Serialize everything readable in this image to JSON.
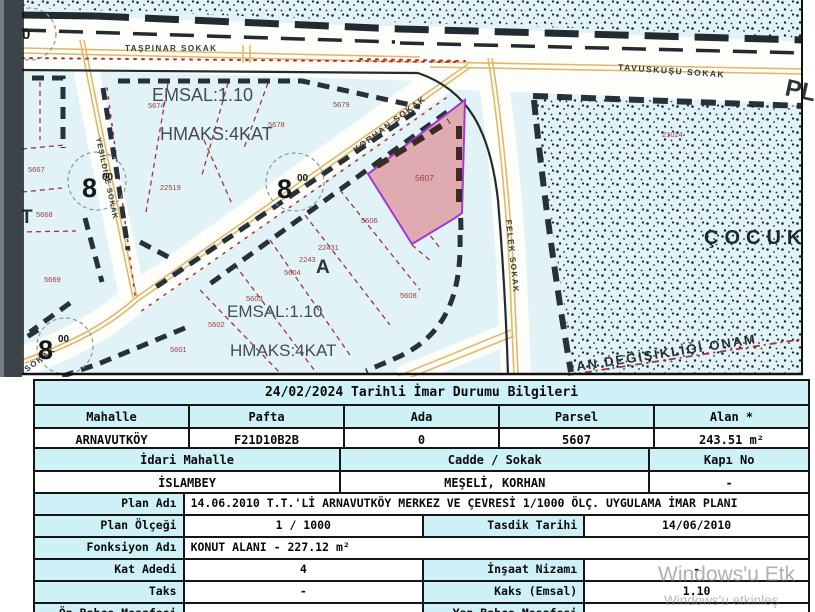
{
  "map": {
    "streets": {
      "taspinar": "TAŞPINAR SOKAK",
      "tavuskusu": "TAVUSKUŞU SOKAK",
      "korhan": "KORHAN SOKAK",
      "yesildide": "YEŞİLDİDE SOKAK",
      "felek": "FELEK SOKAK",
      "sokak_partial": "SOKAK",
      "pl_partial": "PL"
    },
    "zone_labels": {
      "emsal": "EMSAL:1.10",
      "hmaks": "HMAKS:4KAT",
      "cocuk_partial": "ÇOCUK",
      "plan_change_partial": "AN DEĞİŞİKLİĞİ ONAM"
    },
    "road_width": {
      "num": "8",
      "sup": "00",
      "zero_partial": "0"
    },
    "letters": {
      "a": "A",
      "t_partial": "T"
    },
    "highlight_parcel": "5607",
    "parcel_labels": [
      {
        "t": "5607"
      },
      {
        "t": "5606"
      },
      {
        "t": "5608"
      },
      {
        "t": "5601"
      },
      {
        "t": "5602"
      },
      {
        "t": "5603"
      },
      {
        "t": "5604"
      },
      {
        "t": "22431"
      },
      {
        "t": "2243"
      },
      {
        "t": "5667"
      },
      {
        "t": "5668"
      },
      {
        "t": "5669"
      },
      {
        "t": "5674"
      },
      {
        "t": "5678"
      },
      {
        "t": "5679"
      },
      {
        "t": "22519"
      },
      {
        "t": "21024"
      }
    ],
    "colors": {
      "map_bg": "#e2f3f7",
      "road_white": "#fdfdf9",
      "road_yellow": "#dfb869",
      "parcel_fill": "#dfabb0",
      "parcel_border": "#a238d8",
      "parcel_line_red": "#a33636",
      "block_dark": "#26313b",
      "table_header_bg": "#cdf1f6"
    }
  },
  "tables": {
    "parcel_info": {
      "title": "24/02/2024 Tarihli İmar Durumu Bilgileri",
      "headers": [
        "Mahalle",
        "Pafta",
        "Ada",
        "Parsel",
        "Alan *"
      ],
      "values": [
        "ARNAVUTKÖY",
        "F21D10B2B",
        "0",
        "5607",
        "243.51 m²"
      ]
    },
    "address_info": {
      "headers": [
        "İdari Mahalle",
        "Cadde / Sokak",
        "Kapı No"
      ],
      "values": [
        "İSLAMBEY",
        "MEŞELİ, KORHAN",
        "-"
      ]
    },
    "plan_info": {
      "plan_adi_label": "Plan Adı",
      "plan_adi": "14.06.2010 T.T.'Lİ ARNAVUTKÖY MERKEZ VE ÇEVRESİ 1/1000 ÖLÇ. UYGULAMA İMAR PLANI",
      "plan_olcegi_label": "Plan Ölçeği",
      "plan_olcegi": "1 / 1000",
      "tasdik_tarihi_label": "Tasdik Tarihi",
      "tasdik_tarihi": "14/06/2010",
      "fonksiyon_label": "Fonksiyon Adı",
      "fonksiyon": "KONUT ALANI  - 227.12 m²",
      "kat_adedi_label": "Kat Adedi",
      "kat_adedi": "4",
      "insaat_nizami_label": "İnşaat Nizamı",
      "insaat_nizami": "-",
      "taks_label": "Taks",
      "taks": "-",
      "kaks_label": "Kaks (Emsal)",
      "kaks": "1.10",
      "on_bahce_label": "Ön Bahçe Mesafesi",
      "on_bahce": "-",
      "yan_bahce_label": "Yan Bahçe Mesafesi",
      "yan_bahce": ""
    }
  },
  "watermark": {
    "line1": "Windows'u Etk",
    "line2": "Windows'u etkinleş"
  }
}
